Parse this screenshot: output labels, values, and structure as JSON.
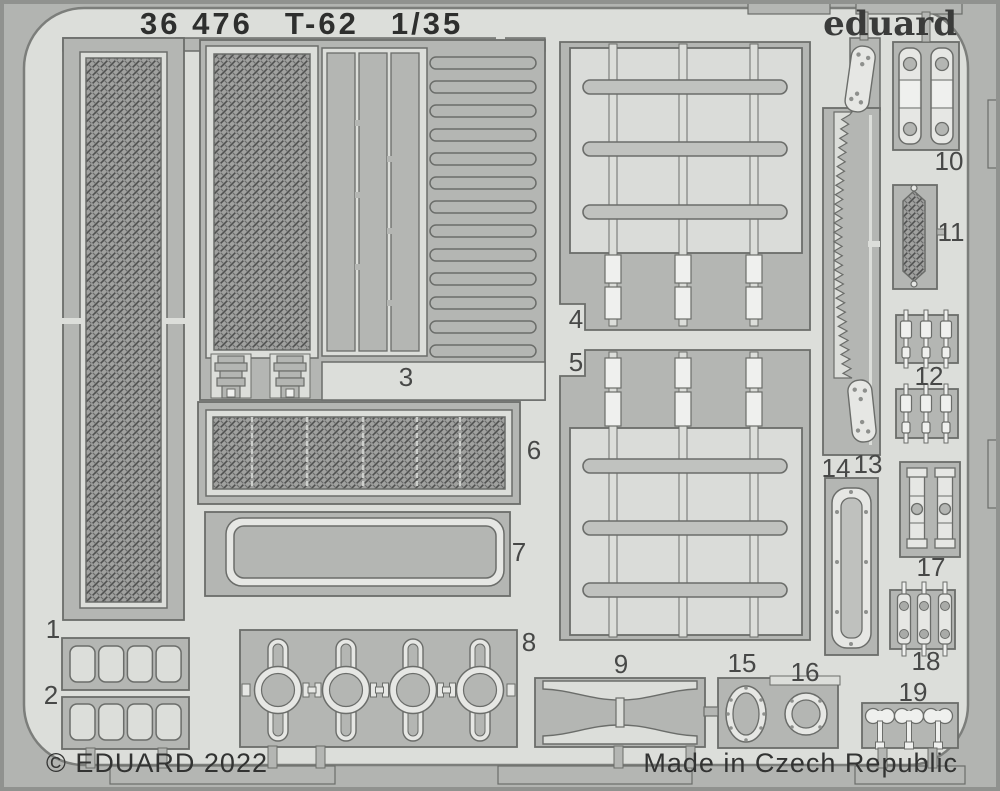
{
  "header": {
    "catalog_number": "36 476",
    "product_name": "T-62",
    "scale": "1/35"
  },
  "brand": {
    "logo_text": "eduard"
  },
  "footer": {
    "copyright": "© EDUARD 2022",
    "origin": "Made in Czech Republic"
  },
  "fret": {
    "part_numbers": [
      "1",
      "2",
      "3",
      "4",
      "5",
      "6",
      "7",
      "8",
      "9",
      "10",
      "11",
      "12",
      "13",
      "14",
      "15",
      "16",
      "17",
      "18",
      "19"
    ]
  },
  "colors": {
    "margin_background": "#b2b4b1",
    "sheet_background": "#dcdeda",
    "metal_gray": "#b4b6b3",
    "outline_gray": "#6b6d6a",
    "mesh_dark": "#8a8a8a",
    "text_dark": "#2e2f2e"
  }
}
